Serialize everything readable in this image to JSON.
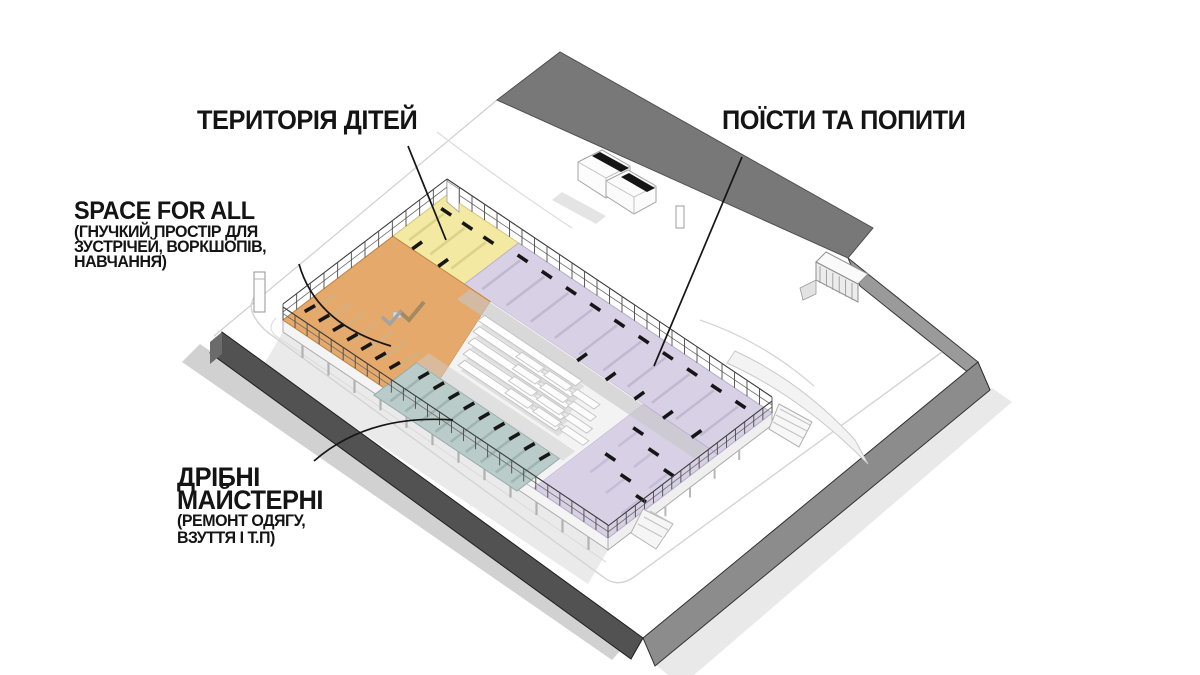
{
  "diagram": {
    "type": "axonometric-architecture-site-diagram",
    "background": "#FFFFFF"
  },
  "labels": {
    "kids_area": {
      "text": "ТЕРИТОРІЯ ДІТЕЙ"
    },
    "eat_and_drink": {
      "text": "ПОЇСТИ ТА ПОПИТИ"
    },
    "space_for_all": {
      "title": "SPACE FOR ALL",
      "subtitle_line1": "(ГНУЧКИЙ ПРОСТІР ДЛЯ",
      "subtitle_line2": "ЗУСТРІЧЕЙ, ВОРКШОПІВ,",
      "subtitle_line3": "НАВЧАННЯ)"
    },
    "small_workshops": {
      "title_line1": "ДРІБНІ",
      "title_line2": "МАЙСТЕРНІ",
      "subtitle_line1": "(РЕМОНТ ОДЯГУ,",
      "subtitle_line2": "ВЗУТТЯ І Т.П)"
    }
  },
  "zones": [
    {
      "id": "kids",
      "name": "ТЕРИТОРІЯ ДІТЕЙ",
      "color": "#F3E9A2"
    },
    {
      "id": "eat_drink",
      "name": "ПОЇСТИ ТА ПОПИТИ",
      "color": "#D8D0E5"
    },
    {
      "id": "space_for_all",
      "name": "SPACE FOR ALL",
      "color": "#E5A96B"
    },
    {
      "id": "workshops",
      "name": "ДРІБНІ МАЙСТЕРНІ",
      "color": "#B9CCCA"
    }
  ],
  "palette": {
    "ink": "#161616",
    "site_wall_top": "#787878",
    "site_wall_left": "#525252",
    "site_wall_right": "#8C8C8C"
  }
}
